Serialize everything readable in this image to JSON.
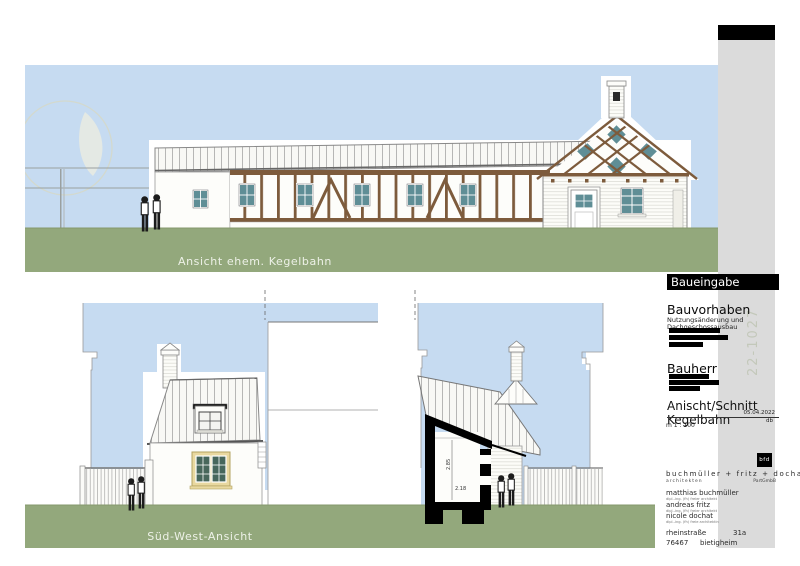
{
  "colors": {
    "sky": "#c6dbf1",
    "ground": "#93a87c",
    "timber": "#7d5b3c",
    "glass_teal": "#5f8e96",
    "window_frame_yellow": "#e9d8a0",
    "pane_green": "#47675c",
    "strip_gray": "#dbdbdb",
    "bar_black": "#000000"
  },
  "drawings": {
    "top_elevation": {
      "label": "Ansicht ehem. Kegelbahn"
    },
    "southwest_elevation": {
      "label": "Süd-West-Ansicht"
    },
    "section": {
      "dim_vertical": "2.85",
      "dim_horizontal": "2.18"
    }
  },
  "title_block": {
    "header": "Baueingabe",
    "project_heading": "Bauvorhaben",
    "project_desc_line1": "Nutzungsänderung und",
    "project_desc_line2": "Dachgeschossausbau",
    "client_heading": "Bauherr",
    "sheet_title": "Anischt/Schnitt Kegelbahn",
    "date": "05.04.2022",
    "initials": "db",
    "scale": "m 1 : 100",
    "project_number": "22-1027",
    "firm": {
      "logo": "bfd",
      "name": "buchmüller + fritz + dochat",
      "descriptor": "architekten",
      "legal_form": "PartGmbB",
      "partners": [
        {
          "name": "matthias buchmüller",
          "title": "dipl.-ing. (fh) freier architekt"
        },
        {
          "name": "andreas fritz",
          "title": "dipl.-ing. (fh) freier architekt"
        },
        {
          "name": "nicole dochat",
          "title": "dipl.-ing. (fh) freie architektin"
        }
      ],
      "street": "rheinstraße",
      "street_no": "31a",
      "zip": "76467",
      "city": "bietigheim"
    }
  }
}
